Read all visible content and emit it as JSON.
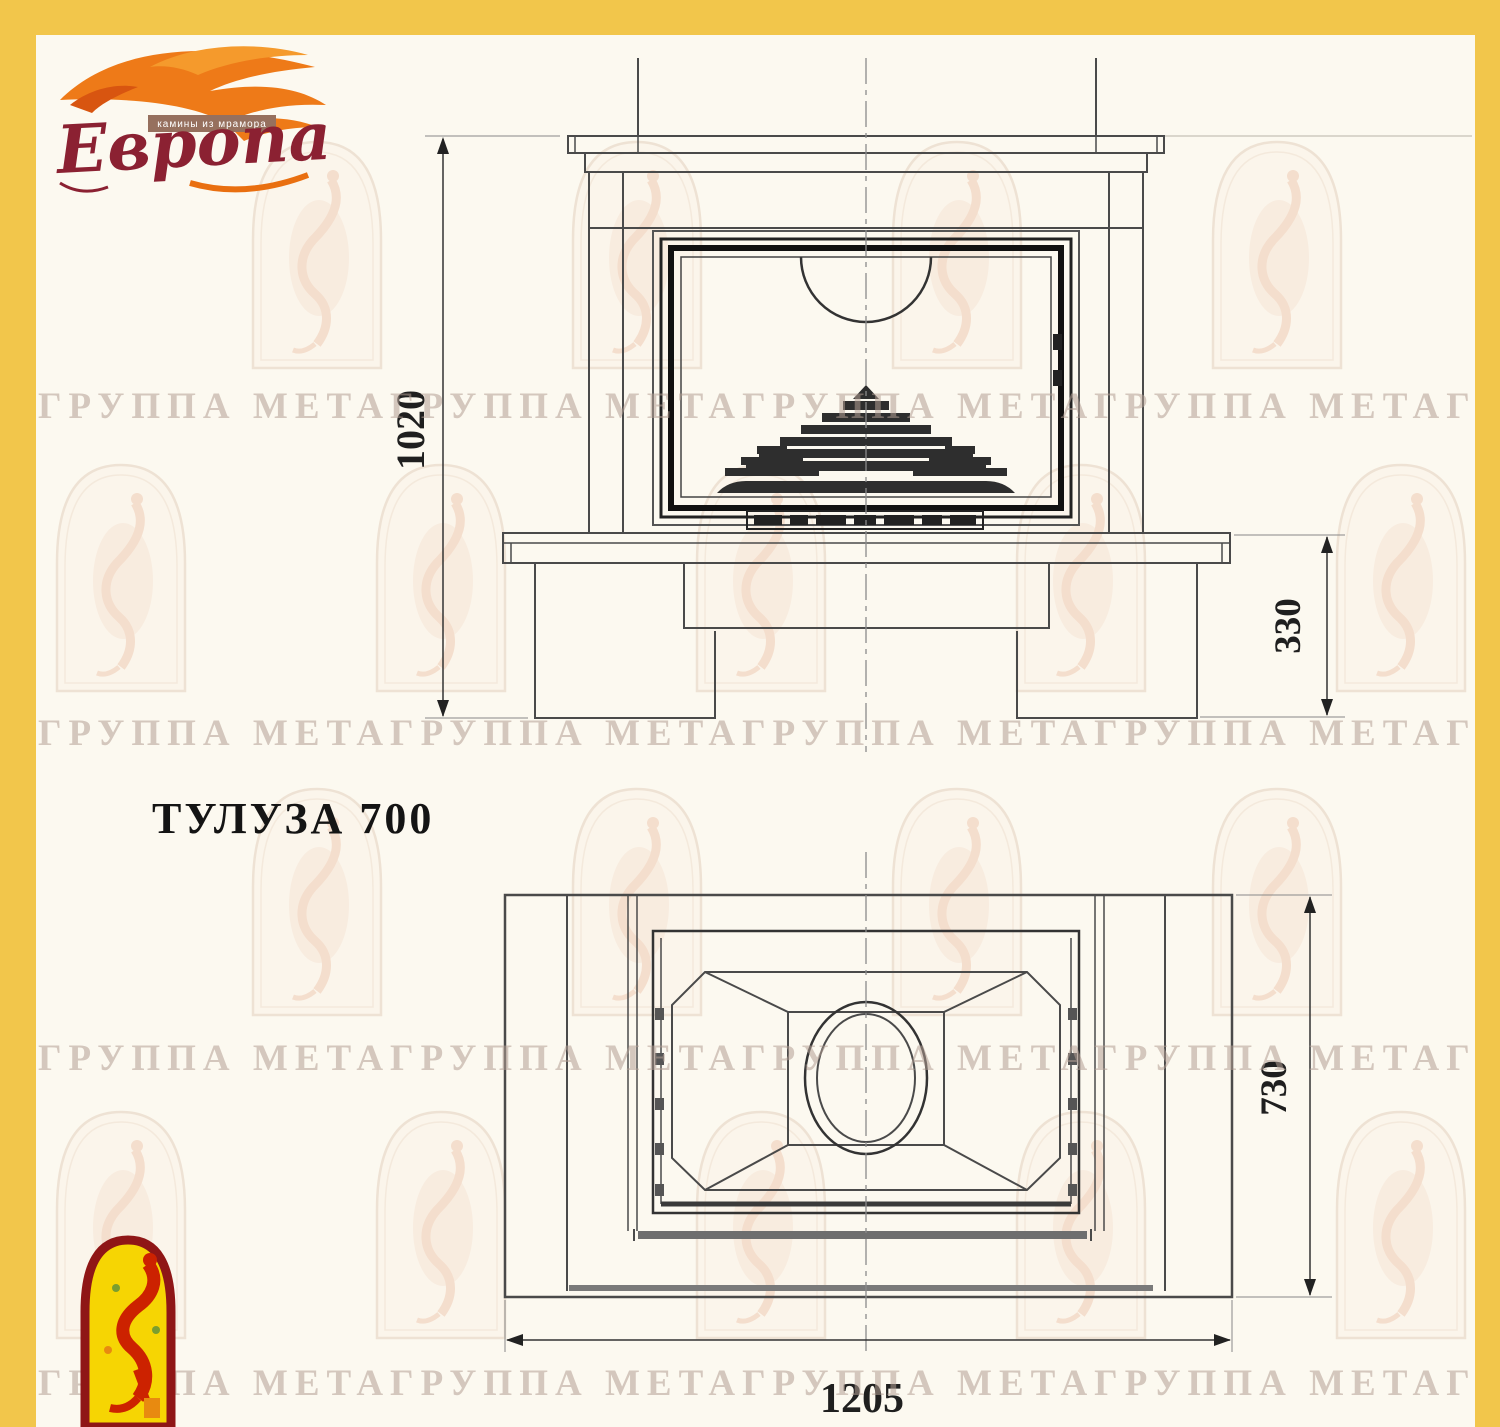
{
  "page": {
    "title_label": "ТУЛУЗА 700"
  },
  "logo": {
    "brand": "Европа",
    "tagline": "камины из мрамора"
  },
  "watermark": {
    "row_text": "ГРУППА МЕТАГРУППА МЕТАГРУППА МЕТАГРУППА МЕТАГРУППА МЕТАГРУППА МЕТА"
  },
  "drawing": {
    "front_view": {
      "overall_height_mm": "1020",
      "base_height_mm": "330"
    },
    "plan_view": {
      "depth_mm": "730",
      "width_mm": "1205"
    }
  },
  "colors": {
    "frame_border": "#F2C64B",
    "logo_flame": "#EE7A18",
    "logo_text": "#8B2132",
    "emblem_yellow": "#F6D503",
    "emblem_red": "#CC2200",
    "emblem_border": "#8F1616",
    "drawing_line": "#4A4A4A",
    "drawing_dark": "#1A1A1A",
    "watermark_text": "#B29E94"
  }
}
